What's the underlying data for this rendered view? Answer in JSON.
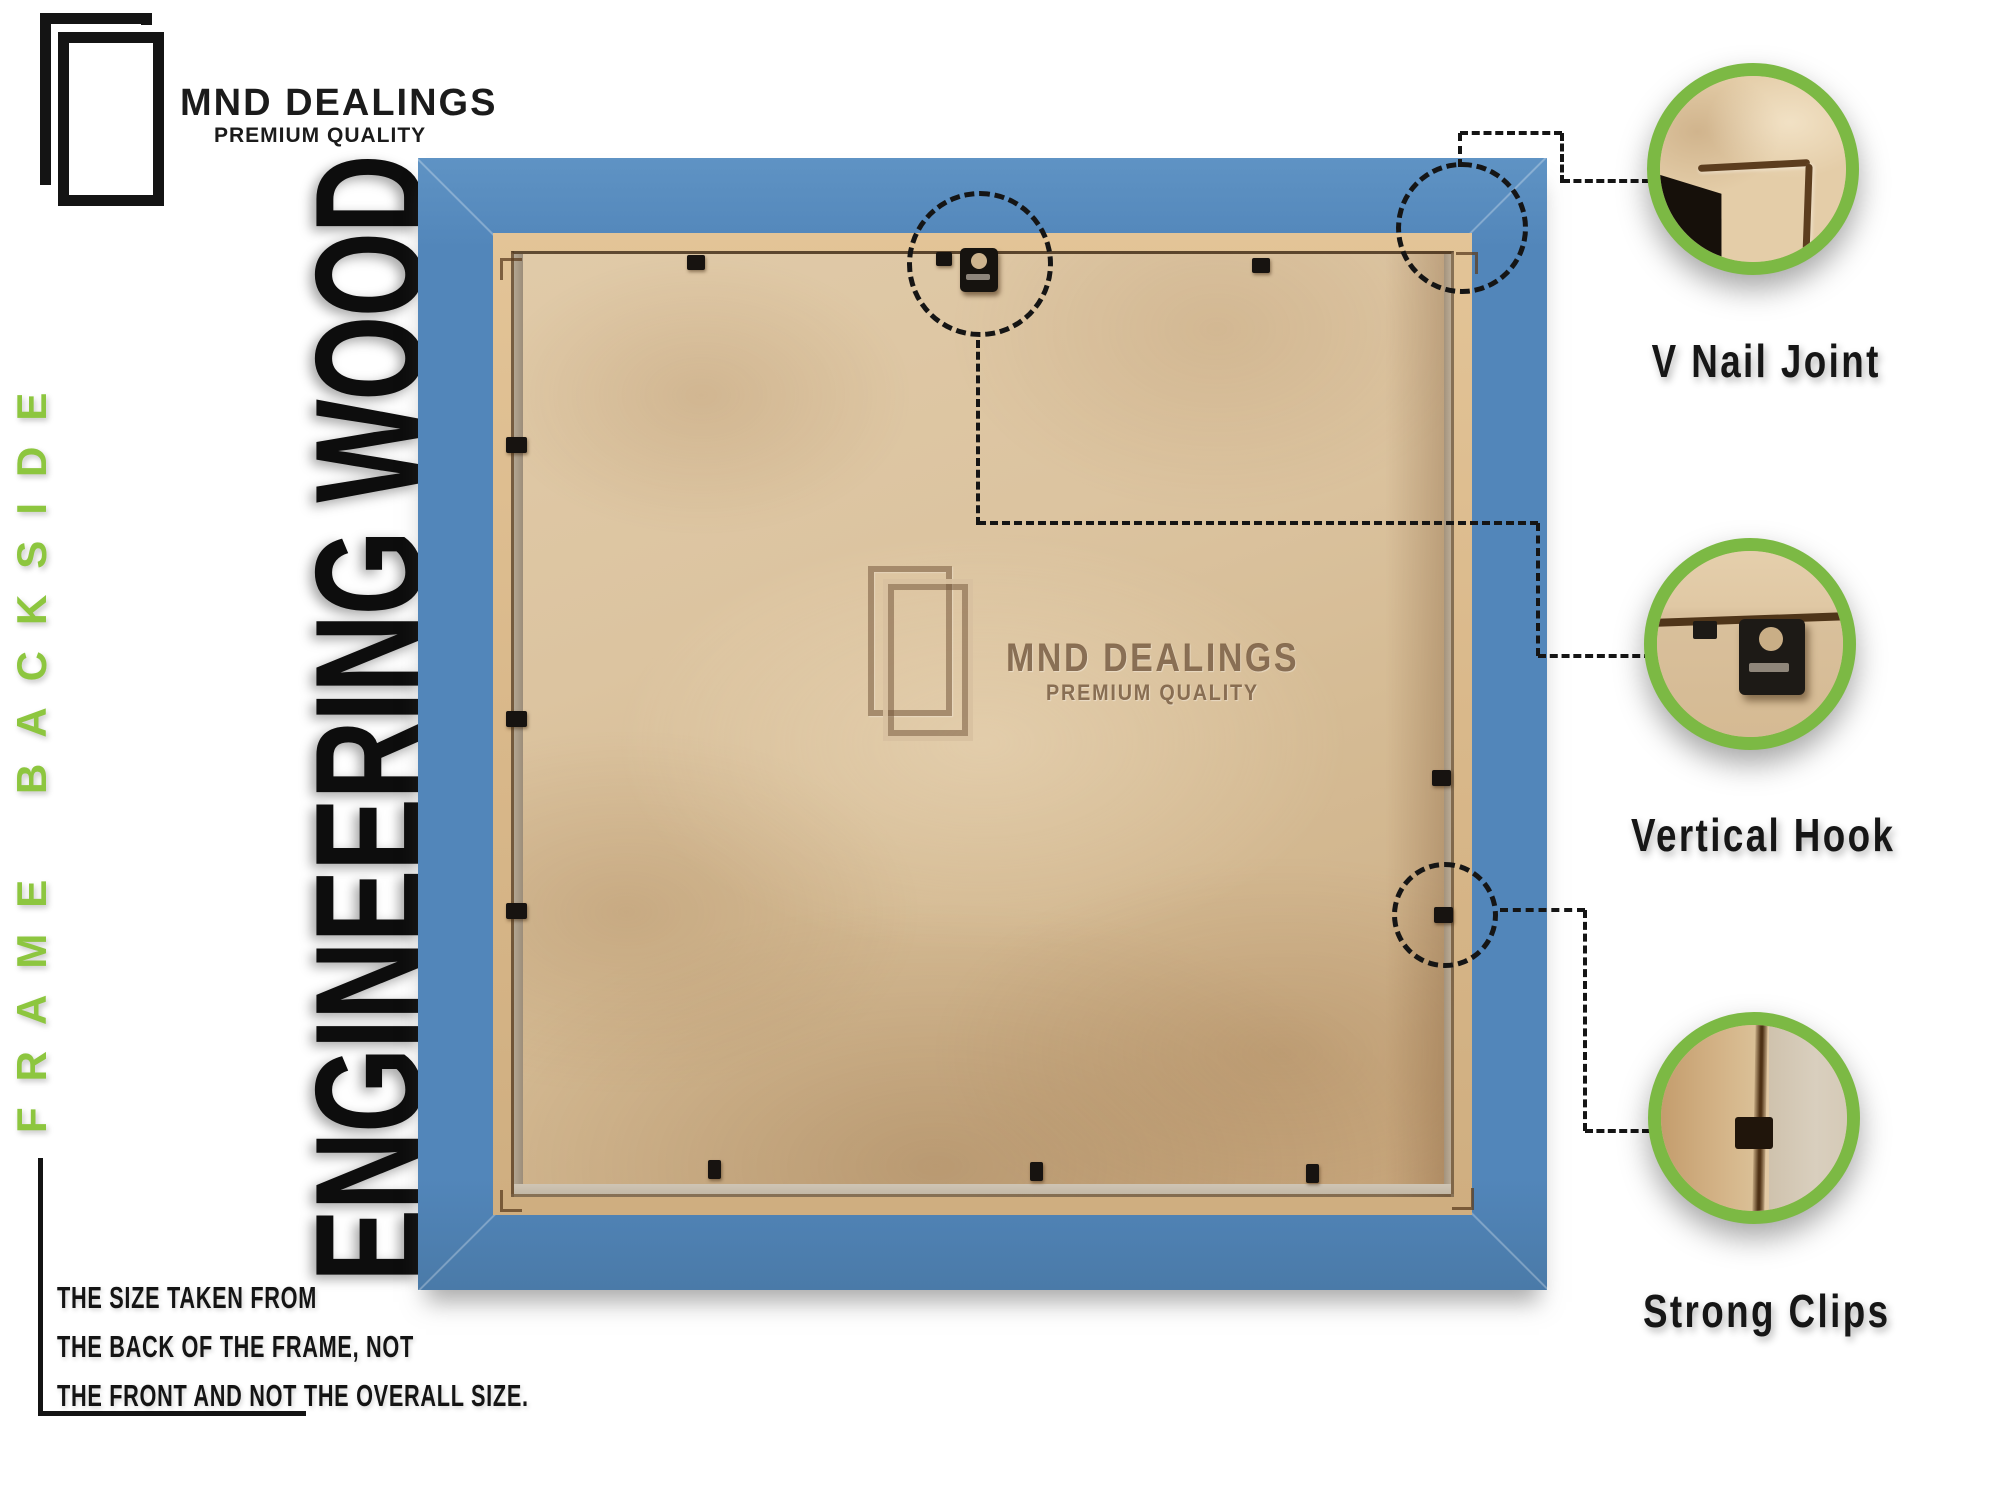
{
  "brand": {
    "name": "MND DEALINGS",
    "tagline": "PREMIUM QUALITY"
  },
  "side_label": "FRAME BACKSIDE",
  "material_label": "ENGINEERING WOOD",
  "watermark": {
    "name": "MND DEALINGS",
    "tagline": "PREMIUM QUALITY"
  },
  "note": {
    "lines": [
      "THE SIZE TAKEN FROM",
      "THE BACK OF THE FRAME, NOT",
      "THE FRONT AND NOT THE OVERALL SIZE."
    ]
  },
  "callouts": [
    {
      "label": "V Nail Joint"
    },
    {
      "label": "Vertical Hook"
    },
    {
      "label": "Strong Clips"
    }
  ],
  "colors": {
    "frame_blue": "#5286ba",
    "accent_green": "#7cb944",
    "side_label_green": "#8dc63f",
    "text_black": "#181818"
  }
}
